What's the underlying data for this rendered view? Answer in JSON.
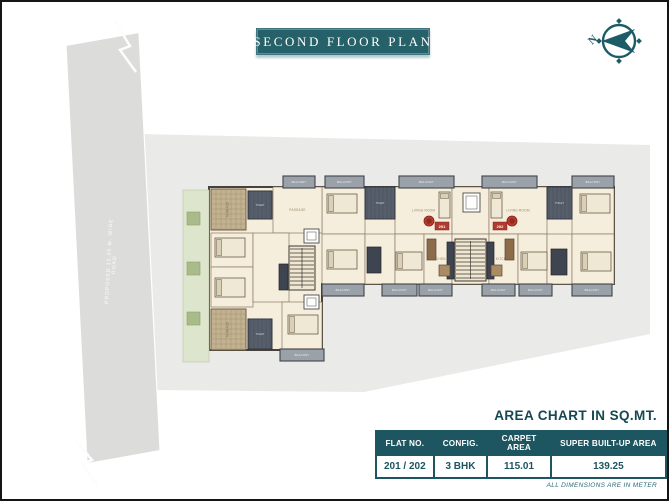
{
  "banner": {
    "title": "SECOND FLOOR PLAN"
  },
  "compass": {
    "north_label": "N"
  },
  "road": {
    "line1": "PROPOSED 12.00 M. WIDE",
    "line2": "ROAD"
  },
  "area_chart": {
    "title": "AREA CHART IN SQ.MT.",
    "columns": [
      "FLAT NO.",
      "CONFIG.",
      "CARPET AREA",
      "SUPER BUILT-UP AREA"
    ],
    "rows": [
      [
        "201 / 202",
        "3 BHK",
        "115.01",
        "139.25"
      ]
    ],
    "footnote": "ALL DIMENSIONS ARE IN METER"
  },
  "colors": {
    "teal": "#1d5560",
    "badge_red": "#b23b30",
    "site_gray": "#eaeae8",
    "plan_cream": "#f6eedd"
  },
  "floorplan": {
    "flat_badges": [
      "201",
      "202"
    ],
    "elements": [
      {
        "t": "garden",
        "x": 181,
        "y": 188,
        "w": 26,
        "h": 172
      },
      {
        "t": "bush",
        "x": 185,
        "y": 210,
        "w": 13,
        "h": 13
      },
      {
        "t": "bush",
        "x": 185,
        "y": 260,
        "w": 13,
        "h": 13
      },
      {
        "t": "bush",
        "x": 185,
        "y": 310,
        "w": 13,
        "h": 13
      },
      {
        "t": "room",
        "x": 320,
        "y": 185,
        "w": 43,
        "h": 47,
        "label": "BEDROOM"
      },
      {
        "t": "room",
        "x": 393,
        "y": 185,
        "w": 57,
        "h": 47,
        "label": "LIVING ROOM"
      },
      {
        "t": "room",
        "x": 450,
        "y": 185,
        "w": 37,
        "h": 47,
        "label": ""
      },
      {
        "t": "room",
        "x": 487,
        "y": 185,
        "w": 58,
        "h": 47,
        "label": "LIVING ROOM"
      },
      {
        "t": "room",
        "x": 570,
        "y": 185,
        "w": 42,
        "h": 47,
        "label": "BEDROOM"
      },
      {
        "t": "room",
        "x": 320,
        "y": 232,
        "w": 43,
        "h": 50,
        "label": "BEDROOM"
      },
      {
        "t": "room",
        "x": 363,
        "y": 232,
        "w": 30,
        "h": 50,
        "label": ""
      },
      {
        "t": "room",
        "x": 393,
        "y": 232,
        "w": 29,
        "h": 50,
        "label": "BEDROOM"
      },
      {
        "t": "room",
        "x": 422,
        "y": 232,
        "w": 28,
        "h": 50,
        "label": "KITCHEN"
      },
      {
        "t": "room",
        "x": 450,
        "y": 232,
        "w": 37,
        "h": 50,
        "label": ""
      },
      {
        "t": "room",
        "x": 487,
        "y": 232,
        "w": 29,
        "h": 50,
        "label": "KITCHEN"
      },
      {
        "t": "room",
        "x": 516,
        "y": 232,
        "w": 29,
        "h": 50,
        "label": "BEDROOM"
      },
      {
        "t": "room",
        "x": 545,
        "y": 232,
        "w": 25,
        "h": 50,
        "label": ""
      },
      {
        "t": "room",
        "x": 570,
        "y": 232,
        "w": 42,
        "h": 50,
        "label": "BEDROOM"
      },
      {
        "t": "room",
        "x": 271,
        "y": 185,
        "w": 49,
        "h": 46,
        "label": "PASSAGE"
      },
      {
        "t": "room",
        "x": 209,
        "y": 231,
        "w": 42,
        "h": 34,
        "label": "BEDROOM"
      },
      {
        "t": "room",
        "x": 209,
        "y": 265,
        "w": 42,
        "h": 40,
        "label": "BEDROOM"
      },
      {
        "t": "room",
        "x": 251,
        "y": 231,
        "w": 36,
        "h": 69,
        "label": ""
      },
      {
        "t": "room",
        "x": 280,
        "y": 300,
        "w": 40,
        "h": 47,
        "label": "BEDROOM"
      },
      {
        "t": "terrace",
        "x": 209,
        "y": 187,
        "w": 35,
        "h": 41,
        "label": "TERRACE"
      },
      {
        "t": "terrace",
        "x": 209,
        "y": 307,
        "w": 35,
        "h": 41,
        "label": "TERRACE"
      },
      {
        "t": "toilet",
        "x": 363,
        "y": 185,
        "w": 30,
        "h": 32,
        "label": "TOILET"
      },
      {
        "t": "toilet",
        "x": 545,
        "y": 185,
        "w": 25,
        "h": 32,
        "label": "TOILET"
      },
      {
        "t": "toilet",
        "x": 246,
        "y": 189,
        "w": 24,
        "h": 28,
        "label": "TOILET"
      },
      {
        "t": "toilet",
        "x": 246,
        "y": 317,
        "w": 24,
        "h": 30,
        "label": "TOILET"
      },
      {
        "t": "stair",
        "x": 287,
        "y": 244,
        "w": 26,
        "h": 44
      },
      {
        "t": "stair",
        "x": 453,
        "y": 237,
        "w": 31,
        "h": 42
      },
      {
        "t": "lift",
        "x": 302,
        "y": 227,
        "w": 15,
        "h": 14
      },
      {
        "t": "lift",
        "x": 302,
        "y": 293,
        "w": 15,
        "h": 14
      },
      {
        "t": "lift",
        "x": 461,
        "y": 191,
        "w": 17,
        "h": 19
      },
      {
        "t": "block",
        "x": 365,
        "y": 245,
        "w": 14,
        "h": 26
      },
      {
        "t": "block",
        "x": 549,
        "y": 247,
        "w": 16,
        "h": 26
      },
      {
        "t": "block",
        "x": 445,
        "y": 240,
        "w": 7,
        "h": 37
      },
      {
        "t": "block",
        "x": 485,
        "y": 240,
        "w": 7,
        "h": 37
      },
      {
        "t": "block",
        "x": 277,
        "y": 262,
        "w": 9,
        "h": 26
      },
      {
        "t": "bed",
        "x": 325,
        "y": 192,
        "w": 30,
        "h": 19
      },
      {
        "t": "bed",
        "x": 578,
        "y": 192,
        "w": 30,
        "h": 19
      },
      {
        "t": "bed",
        "x": 325,
        "y": 248,
        "w": 30,
        "h": 19
      },
      {
        "t": "bed",
        "x": 394,
        "y": 250,
        "w": 26,
        "h": 18
      },
      {
        "t": "bed",
        "x": 519,
        "y": 250,
        "w": 26,
        "h": 18
      },
      {
        "t": "bed",
        "x": 579,
        "y": 250,
        "w": 30,
        "h": 19
      },
      {
        "t": "bed",
        "x": 213,
        "y": 236,
        "w": 30,
        "h": 19
      },
      {
        "t": "bed",
        "x": 213,
        "y": 276,
        "w": 30,
        "h": 19
      },
      {
        "t": "bed",
        "x": 286,
        "y": 313,
        "w": 30,
        "h": 19
      },
      {
        "t": "bed",
        "x": 437,
        "y": 190,
        "w": 11,
        "h": 26
      },
      {
        "t": "bed",
        "x": 489,
        "y": 190,
        "w": 11,
        "h": 26
      },
      {
        "t": "table",
        "x": 425,
        "y": 237,
        "w": 9,
        "h": 21
      },
      {
        "t": "table",
        "x": 503,
        "y": 237,
        "w": 9,
        "h": 21
      },
      {
        "t": "counter",
        "x": 437,
        "y": 263,
        "w": 11,
        "h": 11
      },
      {
        "t": "counter",
        "x": 489,
        "y": 263,
        "w": 11,
        "h": 11
      },
      {
        "t": "chair",
        "x": 427,
        "y": 219,
        "r": 5
      },
      {
        "t": "chair",
        "x": 510,
        "y": 219,
        "r": 5
      },
      {
        "t": "badge",
        "x": 433,
        "y": 220,
        "w": 14,
        "h": 8,
        "label": "201"
      },
      {
        "t": "badge",
        "x": 491,
        "y": 220,
        "w": 14,
        "h": 8,
        "label": "202"
      },
      {
        "t": "balcony",
        "x": 281,
        "y": 174,
        "w": 32,
        "h": 12,
        "label": "BALCONY"
      },
      {
        "t": "balcony",
        "x": 323,
        "y": 174,
        "w": 39,
        "h": 12,
        "label": "BALCONY"
      },
      {
        "t": "balcony",
        "x": 397,
        "y": 174,
        "w": 55,
        "h": 12,
        "label": "BALCONY"
      },
      {
        "t": "balcony",
        "x": 480,
        "y": 174,
        "w": 55,
        "h": 12,
        "label": "BALCONY"
      },
      {
        "t": "balcony",
        "x": 570,
        "y": 174,
        "w": 42,
        "h": 12,
        "label": "BALCONY"
      },
      {
        "t": "balcony",
        "x": 320,
        "y": 282,
        "w": 42,
        "h": 12,
        "label": "BALCONY"
      },
      {
        "t": "balcony",
        "x": 380,
        "y": 282,
        "w": 35,
        "h": 12,
        "label": "BALCONY"
      },
      {
        "t": "balcony",
        "x": 417,
        "y": 282,
        "w": 33,
        "h": 12,
        "label": "BALCONY"
      },
      {
        "t": "balcony",
        "x": 480,
        "y": 282,
        "w": 33,
        "h": 12,
        "label": "BALCONY"
      },
      {
        "t": "balcony",
        "x": 517,
        "y": 282,
        "w": 33,
        "h": 12,
        "label": "BALCONY"
      },
      {
        "t": "balcony",
        "x": 570,
        "y": 282,
        "w": 40,
        "h": 12,
        "label": "BALCONY"
      },
      {
        "t": "balcony",
        "x": 278,
        "y": 347,
        "w": 44,
        "h": 12,
        "label": "BALCONY"
      }
    ]
  }
}
